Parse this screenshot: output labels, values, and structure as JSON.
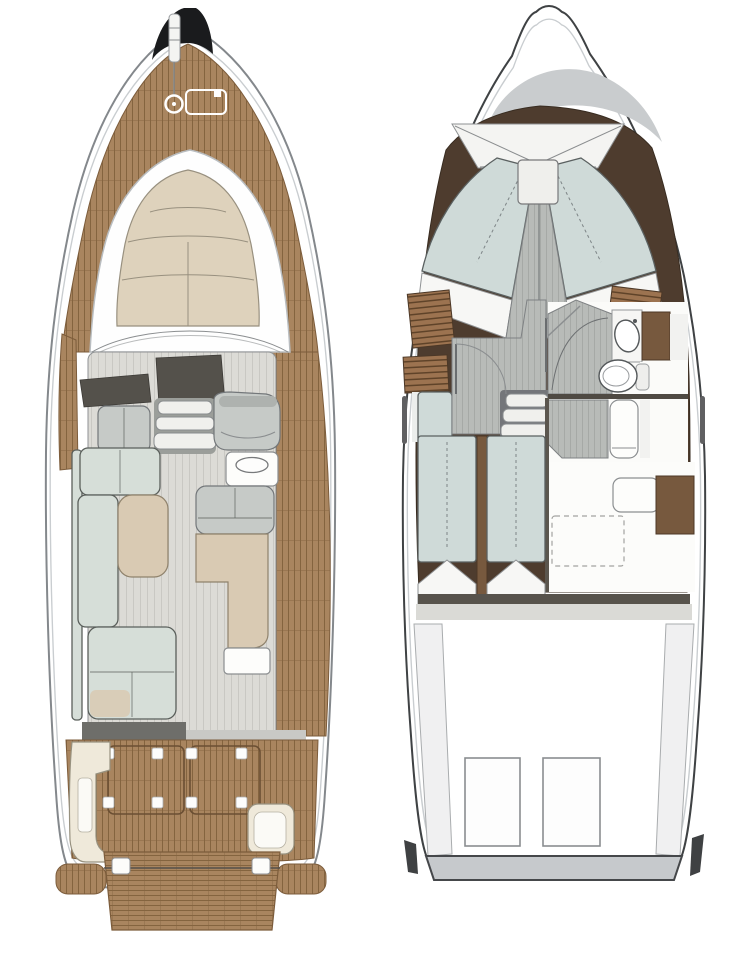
{
  "page": {
    "width": 731,
    "height": 960,
    "background": "#ffffff"
  },
  "diagram": {
    "type": "yacht-floorplan",
    "views": [
      {
        "id": "main-deck-plan",
        "side": "left"
      },
      {
        "id": "lower-deck-plan",
        "side": "right"
      }
    ]
  },
  "colors": {
    "hull_fill": "#ffffff",
    "hull_outline": "#84888c",
    "hull_outline_dark": "#3f4244",
    "inner_rim": "#c9cdd0",
    "teak": "#a9855f",
    "teak_line": "#84643f",
    "teak_dark": "#7c5c3b",
    "sunpad": "#ded2bc",
    "sunpad_line": "#98907f",
    "salon_floor": "#dcdbd6",
    "salon_floor_line": "#c9c8c3",
    "dash_dark": "#54514b",
    "seat_gray": "#c6cac7",
    "sofa": "#d6ded8",
    "sofa_line": "#5a5f5b",
    "beige": "#d9cab3",
    "beige_line": "#8f826c",
    "cream": "#efe9da",
    "cream_line": "#97917f",
    "walls_brown": "#4e3c2e",
    "brown_mid": "#77593e",
    "slat_brown": "#9c7350",
    "slat_line": "#5f4329",
    "lower_floor": "#b8bbb8",
    "lower_floor_line": "#a6a9a6",
    "bed": "#cfdad8",
    "bed_line": "#5a6060",
    "fixture_white": "#fdfdfb",
    "fixture_line": "#8b8e90",
    "crescent": "#c9ccce",
    "engine_line": "#8a8d90",
    "transom": "#c6c9cc",
    "anchor_black": "#1a1b1d",
    "bulkhead_dark": "#57534c",
    "step_fill": "#f0f0ed"
  }
}
